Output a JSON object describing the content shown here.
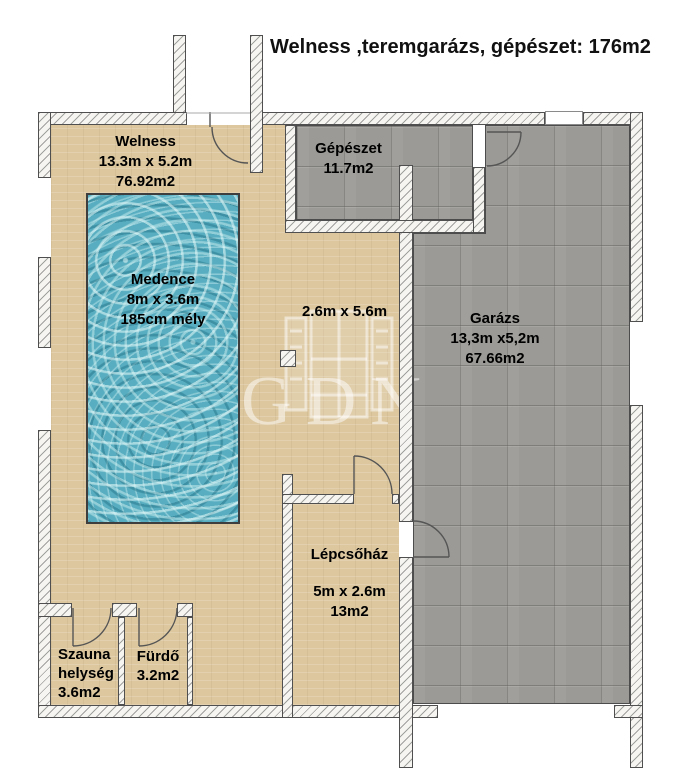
{
  "title": "Welness ,teremgarázs, gépészet: 176m2",
  "watermark": {
    "text": "GDN"
  },
  "rooms": {
    "welness": {
      "name": "Welness",
      "dimensions": "13.3m x 5.2m",
      "area": "76.92m2"
    },
    "gepeszet": {
      "name": "Gépészet",
      "area": "11.7m2"
    },
    "medence": {
      "name": "Medence",
      "dimensions": "8m x 3.6m",
      "depth": "185cm mély"
    },
    "corridor": {
      "dimensions": "2.6m x 5.6m"
    },
    "garazs": {
      "name": "Garázs",
      "dimensions": "13,3m x5,2m",
      "area": "67.66m2"
    },
    "lepcsohaz": {
      "name": "Lépcsőház",
      "dimensions": "5m x 2.6m",
      "area": "13m2"
    },
    "szauna": {
      "name": "Szauna helység",
      "area": "3.6m2"
    },
    "furdo": {
      "name": "Fürdő",
      "area": "3.2m2"
    }
  },
  "colors": {
    "floor-tan": "#dcc79f",
    "floor-concrete": "#9b9a96",
    "pool-water": "#58aec0",
    "wall-outline": "#4f4f4f"
  }
}
